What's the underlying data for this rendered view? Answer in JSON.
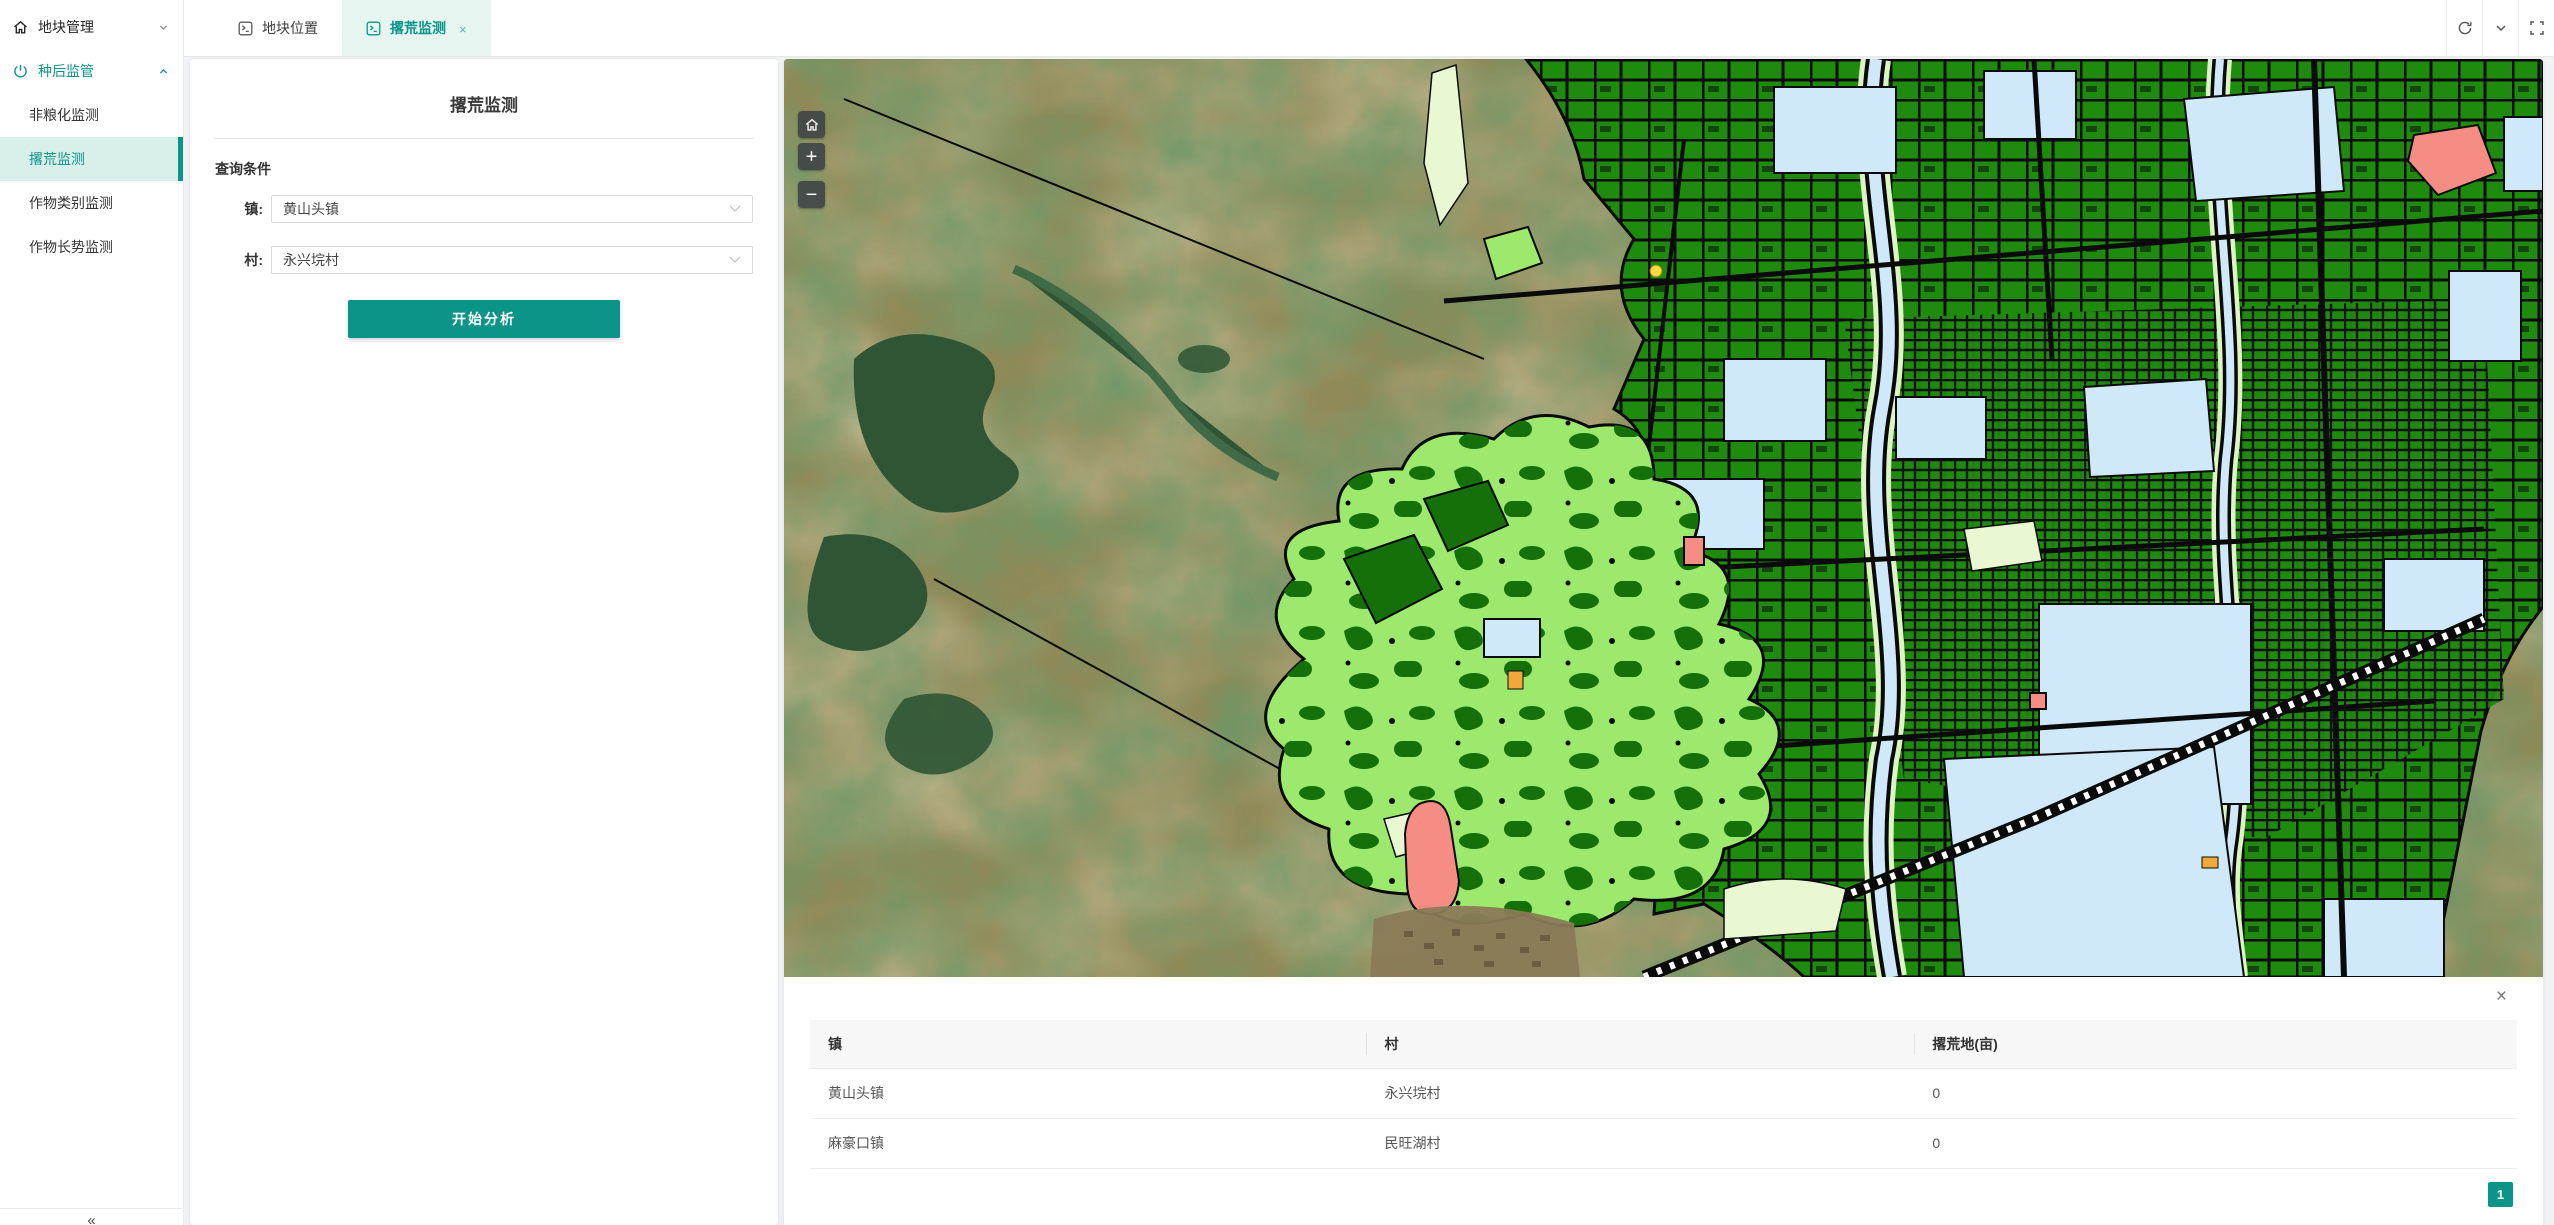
{
  "theme": {
    "accent": "#0d9488",
    "accent_light": "#e7f5f1",
    "sidebar_active_bg": "#d9efeb",
    "table_header_bg": "#f7f7f7",
    "terrain_olive": "#8f8a58",
    "terrain_lake": "#2f5534",
    "map_green": "#1f8b0e",
    "map_green_dark": "#15700a",
    "map_blue": "#cfe9fb",
    "map_chartreuse": "#9ce96d",
    "map_salmon": "#f58d84",
    "map_cream": "#e9f8d2",
    "map_control_bg": "rgba(58,64,68,0.85)"
  },
  "sidebar": {
    "sections": [
      {
        "label": "地块管理",
        "icon": "home-icon",
        "state": "collapsed"
      },
      {
        "label": "种后监管",
        "icon": "power-icon",
        "state": "expanded"
      }
    ],
    "children": [
      "非粮化监测",
      "撂荒监测",
      "作物类别监测",
      "作物长势监测"
    ],
    "active_child": "撂荒监测",
    "collapse": "«"
  },
  "header": {
    "tabs": [
      {
        "label": "地块位置",
        "active": false
      },
      {
        "label": "撂荒监测",
        "active": true,
        "close": "×"
      }
    ],
    "actions": [
      "refresh",
      "collapse-tabs",
      "fullscreen"
    ]
  },
  "form": {
    "title": "撂荒监测",
    "section": "查询条件",
    "town_label": "镇:",
    "town_value": "黄山头镇",
    "village_label": "村:",
    "village_value": "永兴垸村",
    "submit": "开始分析"
  },
  "map": {
    "controls": {
      "zoom_in": "+",
      "zoom_out": "−"
    }
  },
  "results": {
    "close": "×",
    "columns": [
      "镇",
      "村",
      "撂荒地(亩)"
    ],
    "rows": [
      [
        "黄山头镇",
        "永兴垸村",
        "0"
      ],
      [
        "麻豪口镇",
        "民旺湖村",
        "0"
      ]
    ],
    "page": "1"
  }
}
